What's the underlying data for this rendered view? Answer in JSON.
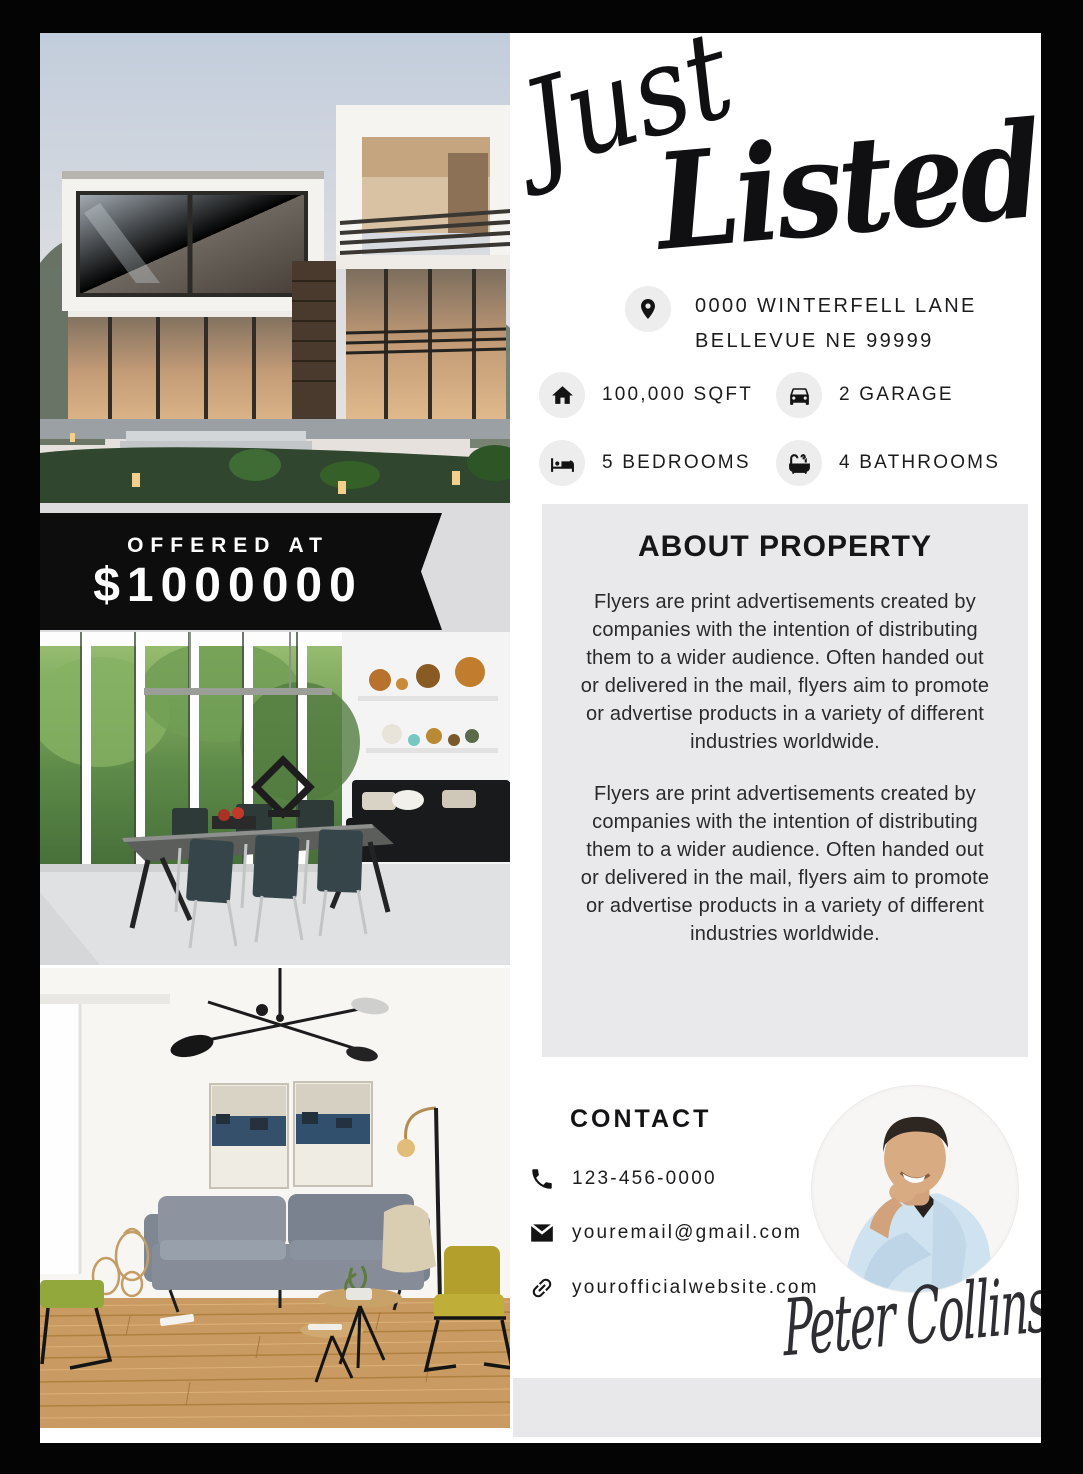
{
  "header": {
    "script_word_1": "Just",
    "script_word_2": "Listed"
  },
  "address": {
    "icon": "location-pin-icon",
    "line1": "0000 WINTERFELL LANE",
    "line2": "BELLEVUE NE 99999"
  },
  "stats": [
    {
      "icon": "house-icon",
      "label": "100,000 SQFT"
    },
    {
      "icon": "car-icon",
      "label": "2 GARAGE"
    },
    {
      "icon": "bed-icon",
      "label": "5 BEDROOMS"
    },
    {
      "icon": "bathtub-icon",
      "label": "4 BATHROOMS"
    }
  ],
  "price": {
    "label": "OFFERED AT",
    "amount": "$1000000"
  },
  "about": {
    "title": "ABOUT PROPERTY",
    "paragraphs": [
      "Flyers are print advertisements created by companies with the intention of distributing them to a wider audience. Often handed out or delivered in the mail, flyers aim to promote or advertise products in a variety of different industries worldwide.",
      "Flyers are print advertisements created by companies with the intention of distributing them to a wider audience. Often handed out or delivered in the mail, flyers aim to promote or advertise products in a variety of different industries worldwide."
    ]
  },
  "contact": {
    "title": "CONTACT",
    "items": [
      {
        "icon": "phone-icon",
        "value": "123-456-0000"
      },
      {
        "icon": "envelope-icon",
        "value": "youremail@gmail.com"
      },
      {
        "icon": "link-icon",
        "value": "yourofficialwebsite.com"
      }
    ]
  },
  "agent": {
    "photo": "agent-portrait",
    "signature": "Peter Collins"
  },
  "photos": {
    "hero": "modern-house-exterior-at-dusk",
    "middle": "dining-room-interior",
    "bottom": "living-room-interior"
  },
  "colors": {
    "banner_black": "#0d0d0d",
    "price_band_gray": "#dcdcdf",
    "about_bg": "#e9e9ec",
    "icon_circle_bg": "#ededee",
    "footer_band": "#e8e8eb",
    "text": "#1d1d1f"
  }
}
